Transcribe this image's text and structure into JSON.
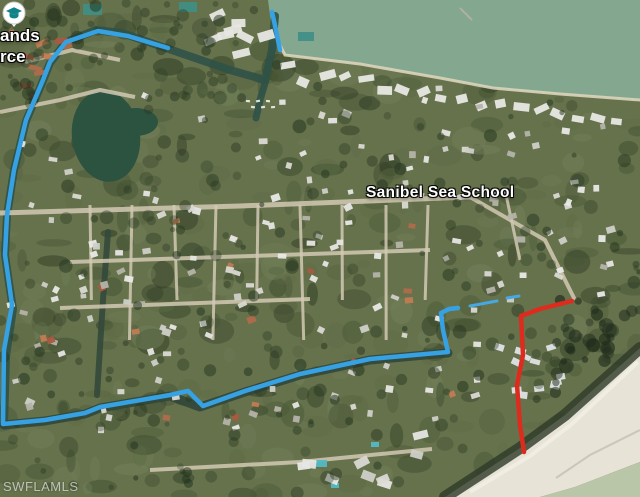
{
  "map": {
    "labels": {
      "poi_school": "Sanibel Sea School",
      "partial_top_left_line1": "ands",
      "partial_top_left_line2": "rce",
      "watermark": "SWFLAMLS"
    },
    "icons": {
      "school_icon": "graduation-cap-map-pin"
    },
    "colors": {
      "route_blue": "#37a2e3",
      "route_red": "#dd2c1e",
      "bay_water": "#84a78f",
      "gulf_water": "#bac6a8",
      "beach_sand": "#e7e3d6",
      "canal_water": "#2f5247",
      "school_icon_teal": "#11848b"
    },
    "overlays": {
      "routes": [
        {
          "name": "blue-route-main",
          "color": "#37a2e3",
          "width": 4.5,
          "points": [
            [
              168,
              48
            ],
            [
              128,
              36
            ],
            [
              98,
              31
            ],
            [
              66,
              42
            ],
            [
              50,
              62
            ],
            [
              43,
              80
            ],
            [
              26,
              120
            ],
            [
              14,
              170
            ],
            [
              7,
              215
            ],
            [
              5,
              255
            ],
            [
              9,
              283
            ],
            [
              12,
              305
            ],
            [
              4,
              350
            ],
            [
              3,
              424
            ],
            [
              45,
              420
            ],
            [
              85,
              413
            ],
            [
              100,
              407
            ],
            [
              170,
              395
            ],
            [
              188,
              391
            ],
            [
              203,
              406
            ],
            [
              245,
              391
            ],
            [
              300,
              374
            ],
            [
              370,
              359
            ],
            [
              448,
              352
            ],
            [
              443,
              330
            ],
            [
              441,
              313
            ],
            [
              449,
              309
            ],
            [
              458,
              308
            ]
          ]
        },
        {
          "name": "blue-route-bay-spur",
          "color": "#37a2e3",
          "width": 4.5,
          "points": [
            [
              272,
              12
            ],
            [
              276,
              30
            ],
            [
              280,
              50
            ]
          ]
        },
        {
          "name": "blue-route-dashed-tail",
          "color": "#45a8e0",
          "width": 3,
          "segments": [
            [
              [
                470,
                306
              ],
              [
                497,
                301
              ]
            ],
            [
              [
                507,
                298
              ],
              [
                519,
                296
              ]
            ]
          ]
        },
        {
          "name": "red-route",
          "color": "#dd2c1e",
          "width": 4.5,
          "points": [
            [
              572,
              301
            ],
            [
              540,
              309
            ],
            [
              521,
              316
            ],
            [
              523,
              355
            ],
            [
              517,
              385
            ],
            [
              520,
              425
            ],
            [
              524,
              452
            ]
          ]
        }
      ]
    }
  }
}
